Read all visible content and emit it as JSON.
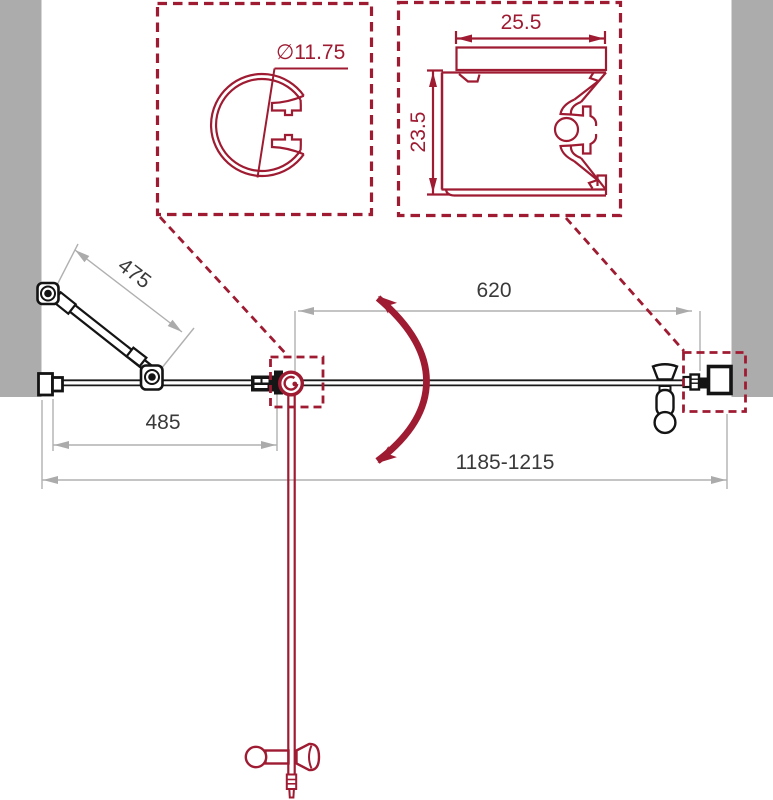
{
  "colors": {
    "accent_red": "#9E1B32",
    "wall_gray": "#ACACAC",
    "dim_line_gray": "#B0B0B0",
    "line_black": "#1A1A1A",
    "dim_text": "#3A3A3A"
  },
  "detail_views": {
    "knob_profile": {
      "diameter": "∅11.75"
    },
    "wall_profile": {
      "width": "25.5",
      "height": "23.5"
    }
  },
  "plan_view": {
    "support_bar_length": "475",
    "fixed_panel_width": "485",
    "door_panel_width": "620",
    "overall_width_range": "1185-1215"
  }
}
